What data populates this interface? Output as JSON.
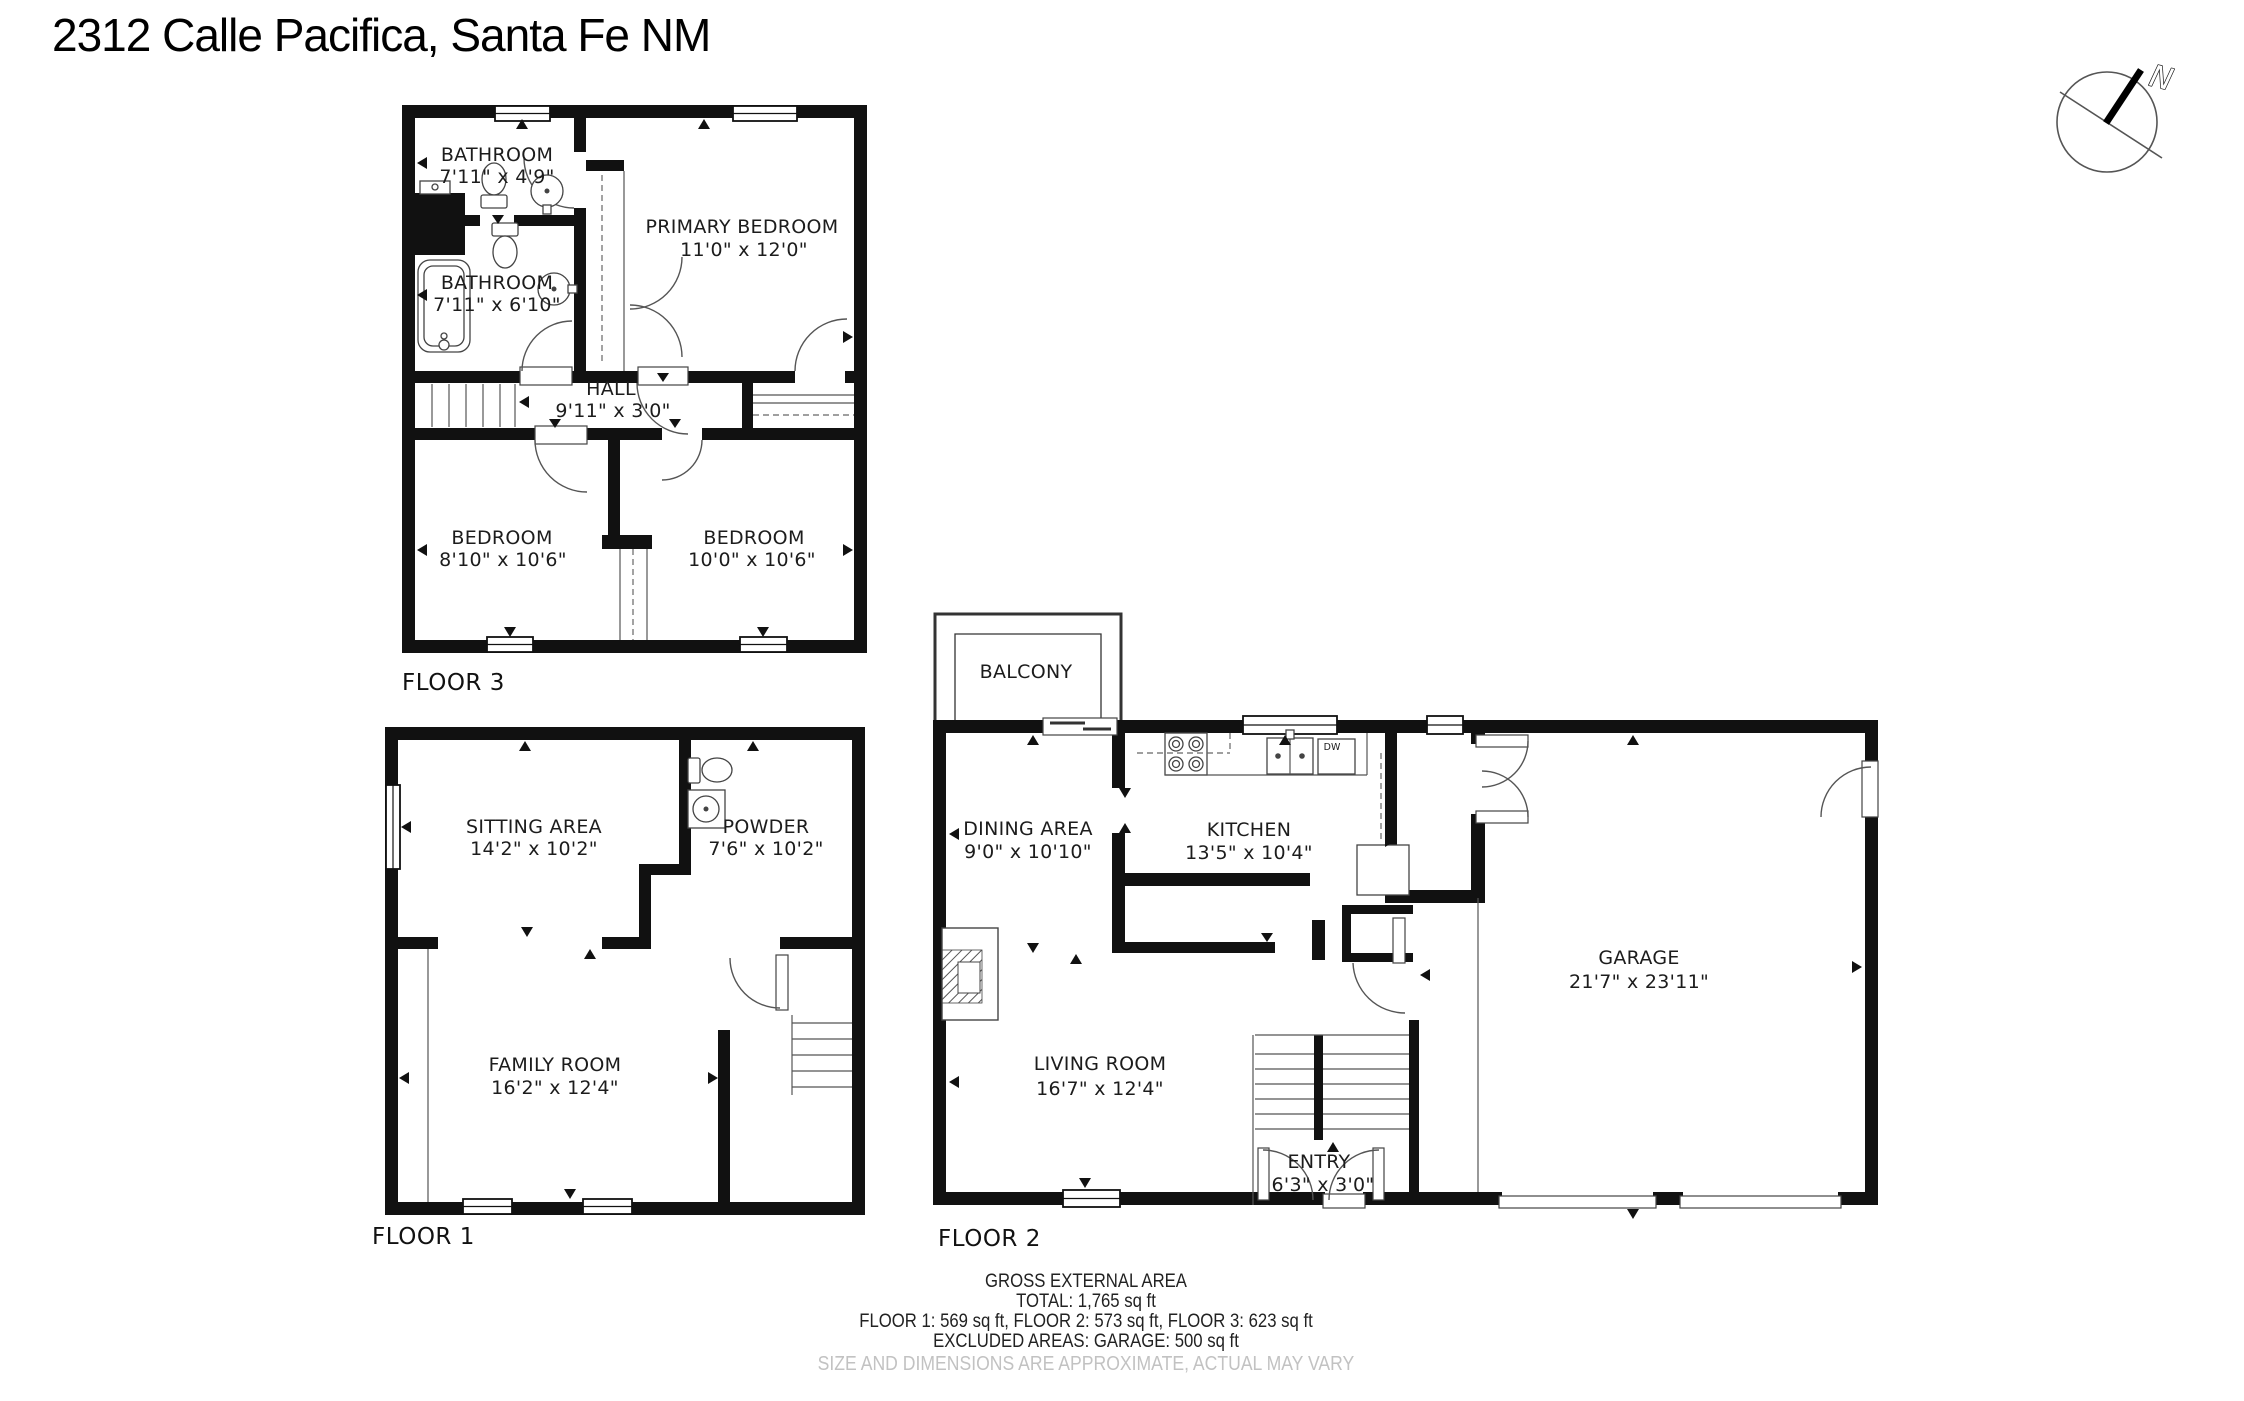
{
  "title": "2312 Calle Pacifica, Santa Fe NM",
  "compass": {
    "north_label": "N"
  },
  "floor3": {
    "label": "FLOOR 3",
    "bathroom_top": {
      "name": "BATHROOM",
      "dims": "7'11\" x 4'9\""
    },
    "bathroom_bottom": {
      "name": "BATHROOM",
      "dims": "7'11\" x 6'10\""
    },
    "primary_bedroom": {
      "name": "PRIMARY BEDROOM",
      "dims": "11'0\" x 12'0\""
    },
    "hall": {
      "name": "HALL",
      "dims": "9'11\" x 3'0\""
    },
    "bedroom_left": {
      "name": "BEDROOM",
      "dims": "8'10\" x 10'6\""
    },
    "bedroom_right": {
      "name": "BEDROOM",
      "dims": "10'0\" x 10'6\""
    }
  },
  "floor1": {
    "label": "FLOOR 1",
    "sitting_area": {
      "name": "SITTING AREA",
      "dims": "14'2\" x 10'2\""
    },
    "powder": {
      "name": "POWDER",
      "dims": "7'6\" x 10'2\""
    },
    "family_room": {
      "name": "FAMILY ROOM",
      "dims": "16'2\" x 12'4\""
    }
  },
  "floor2": {
    "label": "FLOOR 2",
    "balcony": {
      "name": "BALCONY"
    },
    "dining_area": {
      "name": "DINING AREA",
      "dims": "9'0\" x 10'10\""
    },
    "kitchen": {
      "name": "KITCHEN",
      "dims": "13'5\" x 10'4\""
    },
    "living_room": {
      "name": "LIVING ROOM",
      "dims": "16'7\" x 12'4\""
    },
    "entry": {
      "name": "ENTRY",
      "dims": "6'3\" x 3'0\""
    },
    "garage": {
      "name": "GARAGE",
      "dims": "21'7\" x 23'11\""
    },
    "appliances": {
      "dishwasher": "DW"
    }
  },
  "footer": {
    "heading": "GROSS EXTERNAL AREA",
    "total": "TOTAL: 1,765 sq ft",
    "floors": "FLOOR 1: 569 sq ft, FLOOR 2: 573 sq ft, FLOOR 3: 623 sq ft",
    "excluded": "EXCLUDED AREAS: GARAGE: 500 sq ft",
    "disclaimer": "SIZE AND DIMENSIONS ARE APPROXIMATE, ACTUAL MAY VARY"
  }
}
